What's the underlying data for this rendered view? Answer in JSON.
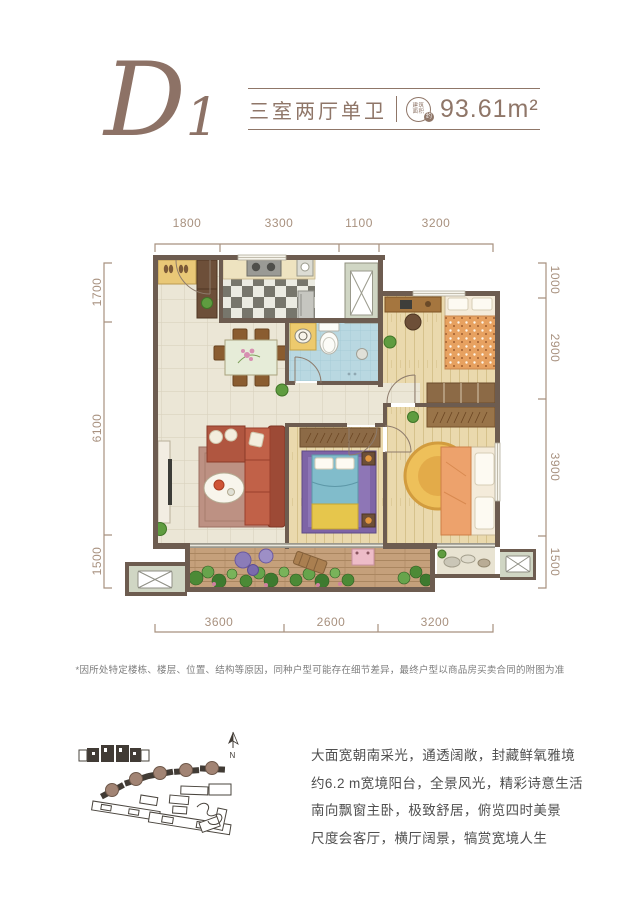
{
  "header": {
    "plan_code": "D1",
    "layout_label": "三室两厅单卫",
    "area_icon": {
      "line1": "建筑",
      "line2": "面积",
      "approx": "约"
    },
    "area_text": "93.61m²"
  },
  "dims": {
    "top": [
      "1800",
      "3300",
      "1100",
      "3200"
    ],
    "left": [
      "1700",
      "6100",
      "1500"
    ],
    "right": [
      "1000",
      "2900",
      "3900",
      "1500"
    ],
    "bottom": [
      "3600",
      "2600",
      "3200"
    ]
  },
  "disclaimer": "*因所处特定楼栋、楼层、位置、结构等原因，同种户型可能存在细节差异，最终户型以商品房买卖合同的附图为准",
  "description": {
    "lines": [
      "大面宽朝南采光，通透阔敞，封藏鲜氧雅境",
      "约6.2 m宽境阳台，全景风光，精彩诗意生活",
      "南向飘窗主卧，极致舒居，俯览四时美景",
      "尺度会客厅，横厅阔景，犒赏宽境人生"
    ]
  },
  "siteplan": {
    "compass_label": "N"
  },
  "colors": {
    "accent": "#8d7266",
    "wall": "#6d5c50",
    "dimension": "#a8917f",
    "body_text": "#4f4f4f",
    "bathroom_tile": "#b9d8e1",
    "wood_floor": "#ead9ad",
    "sofa": "#c16148"
  }
}
